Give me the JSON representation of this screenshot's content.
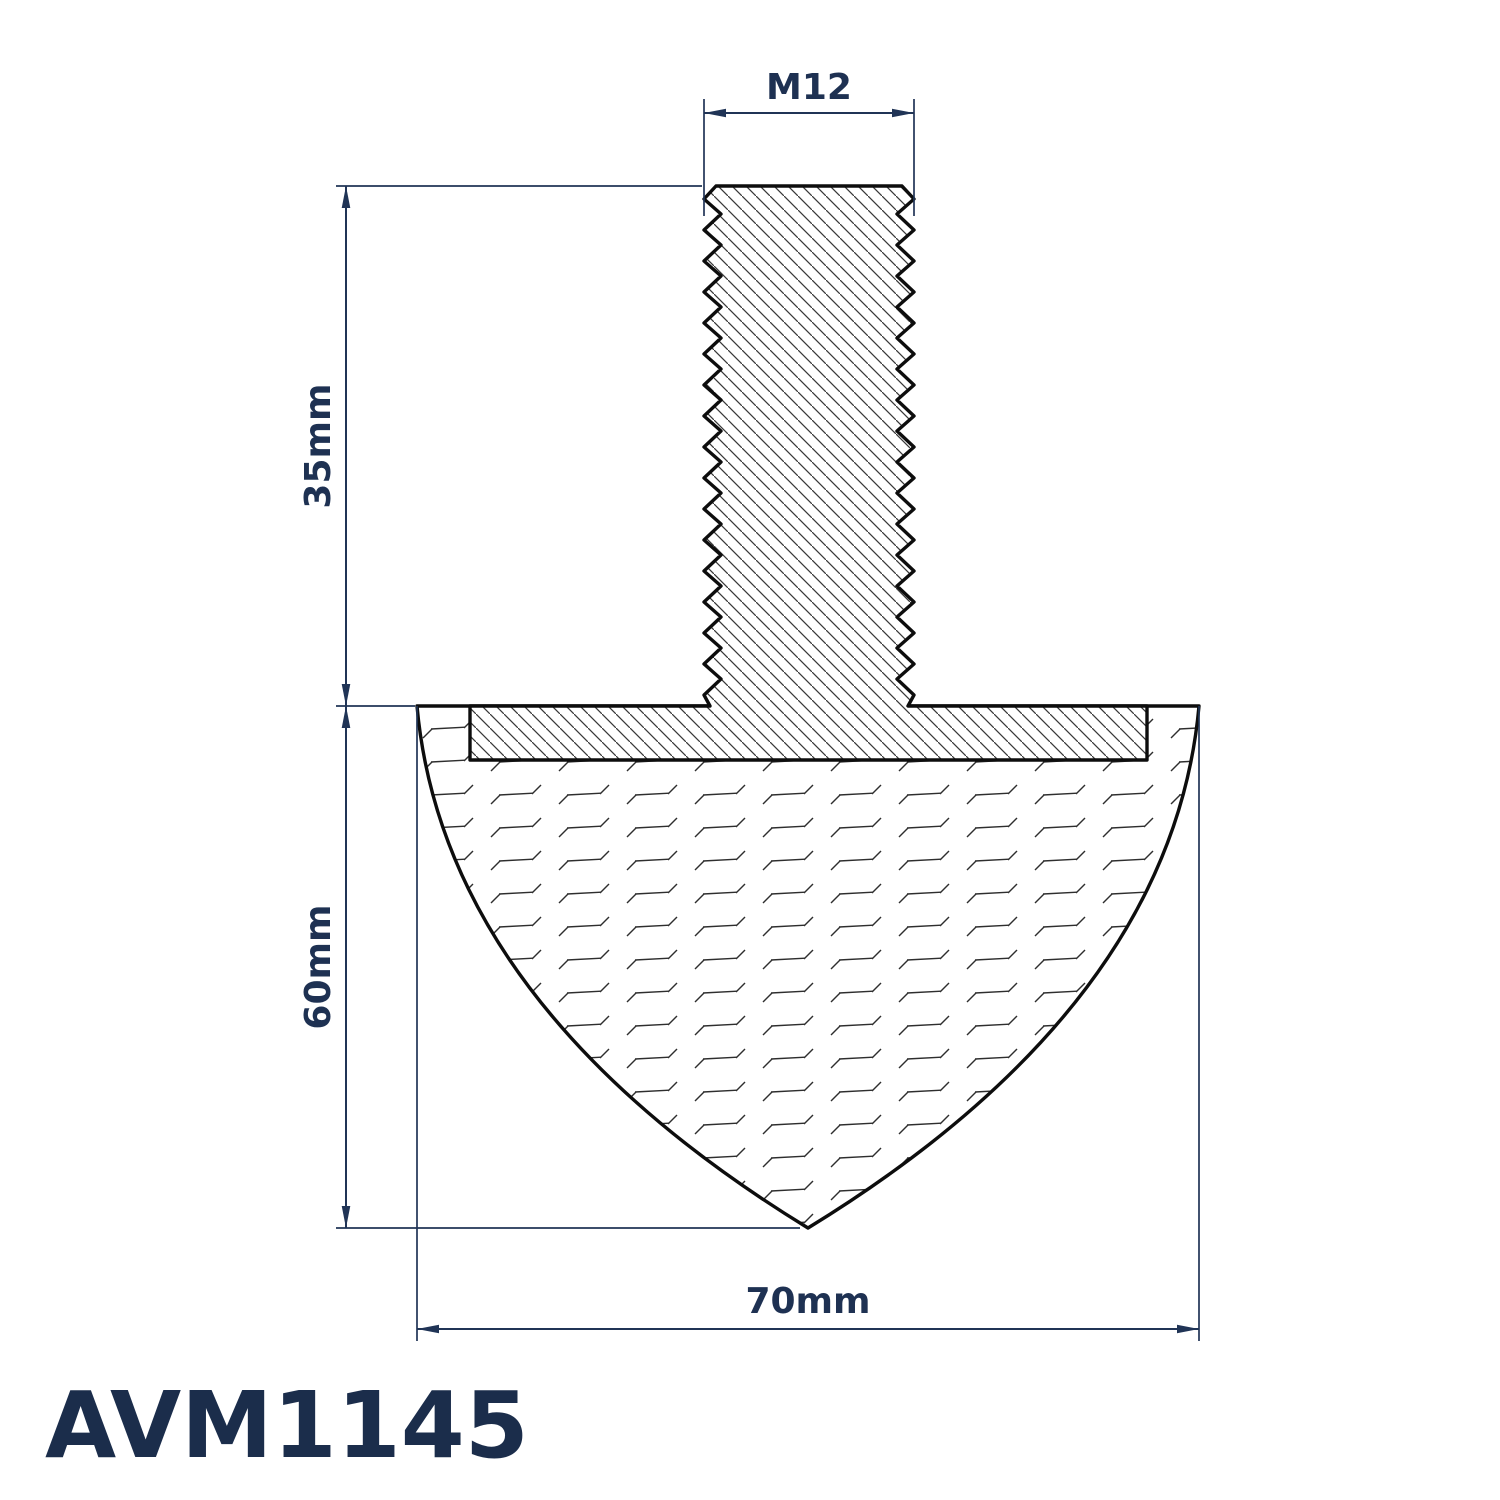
{
  "part_number": "AVM1145",
  "drawing": {
    "type": "technical-section-drawing",
    "subject": "anti-vibration mount: parabolic rubber buffer with bonded plate and threaded stud"
  },
  "dimensions": {
    "thread": "M12",
    "stud_length": "35mm",
    "body_height": "60mm",
    "body_width": "70mm"
  },
  "colors": {
    "dimension_navy": "#203456",
    "label_navy": "#1e3152",
    "title_navy": "#1b2d4b",
    "outline_black": "#0d0d0d",
    "background": "#ffffff"
  }
}
